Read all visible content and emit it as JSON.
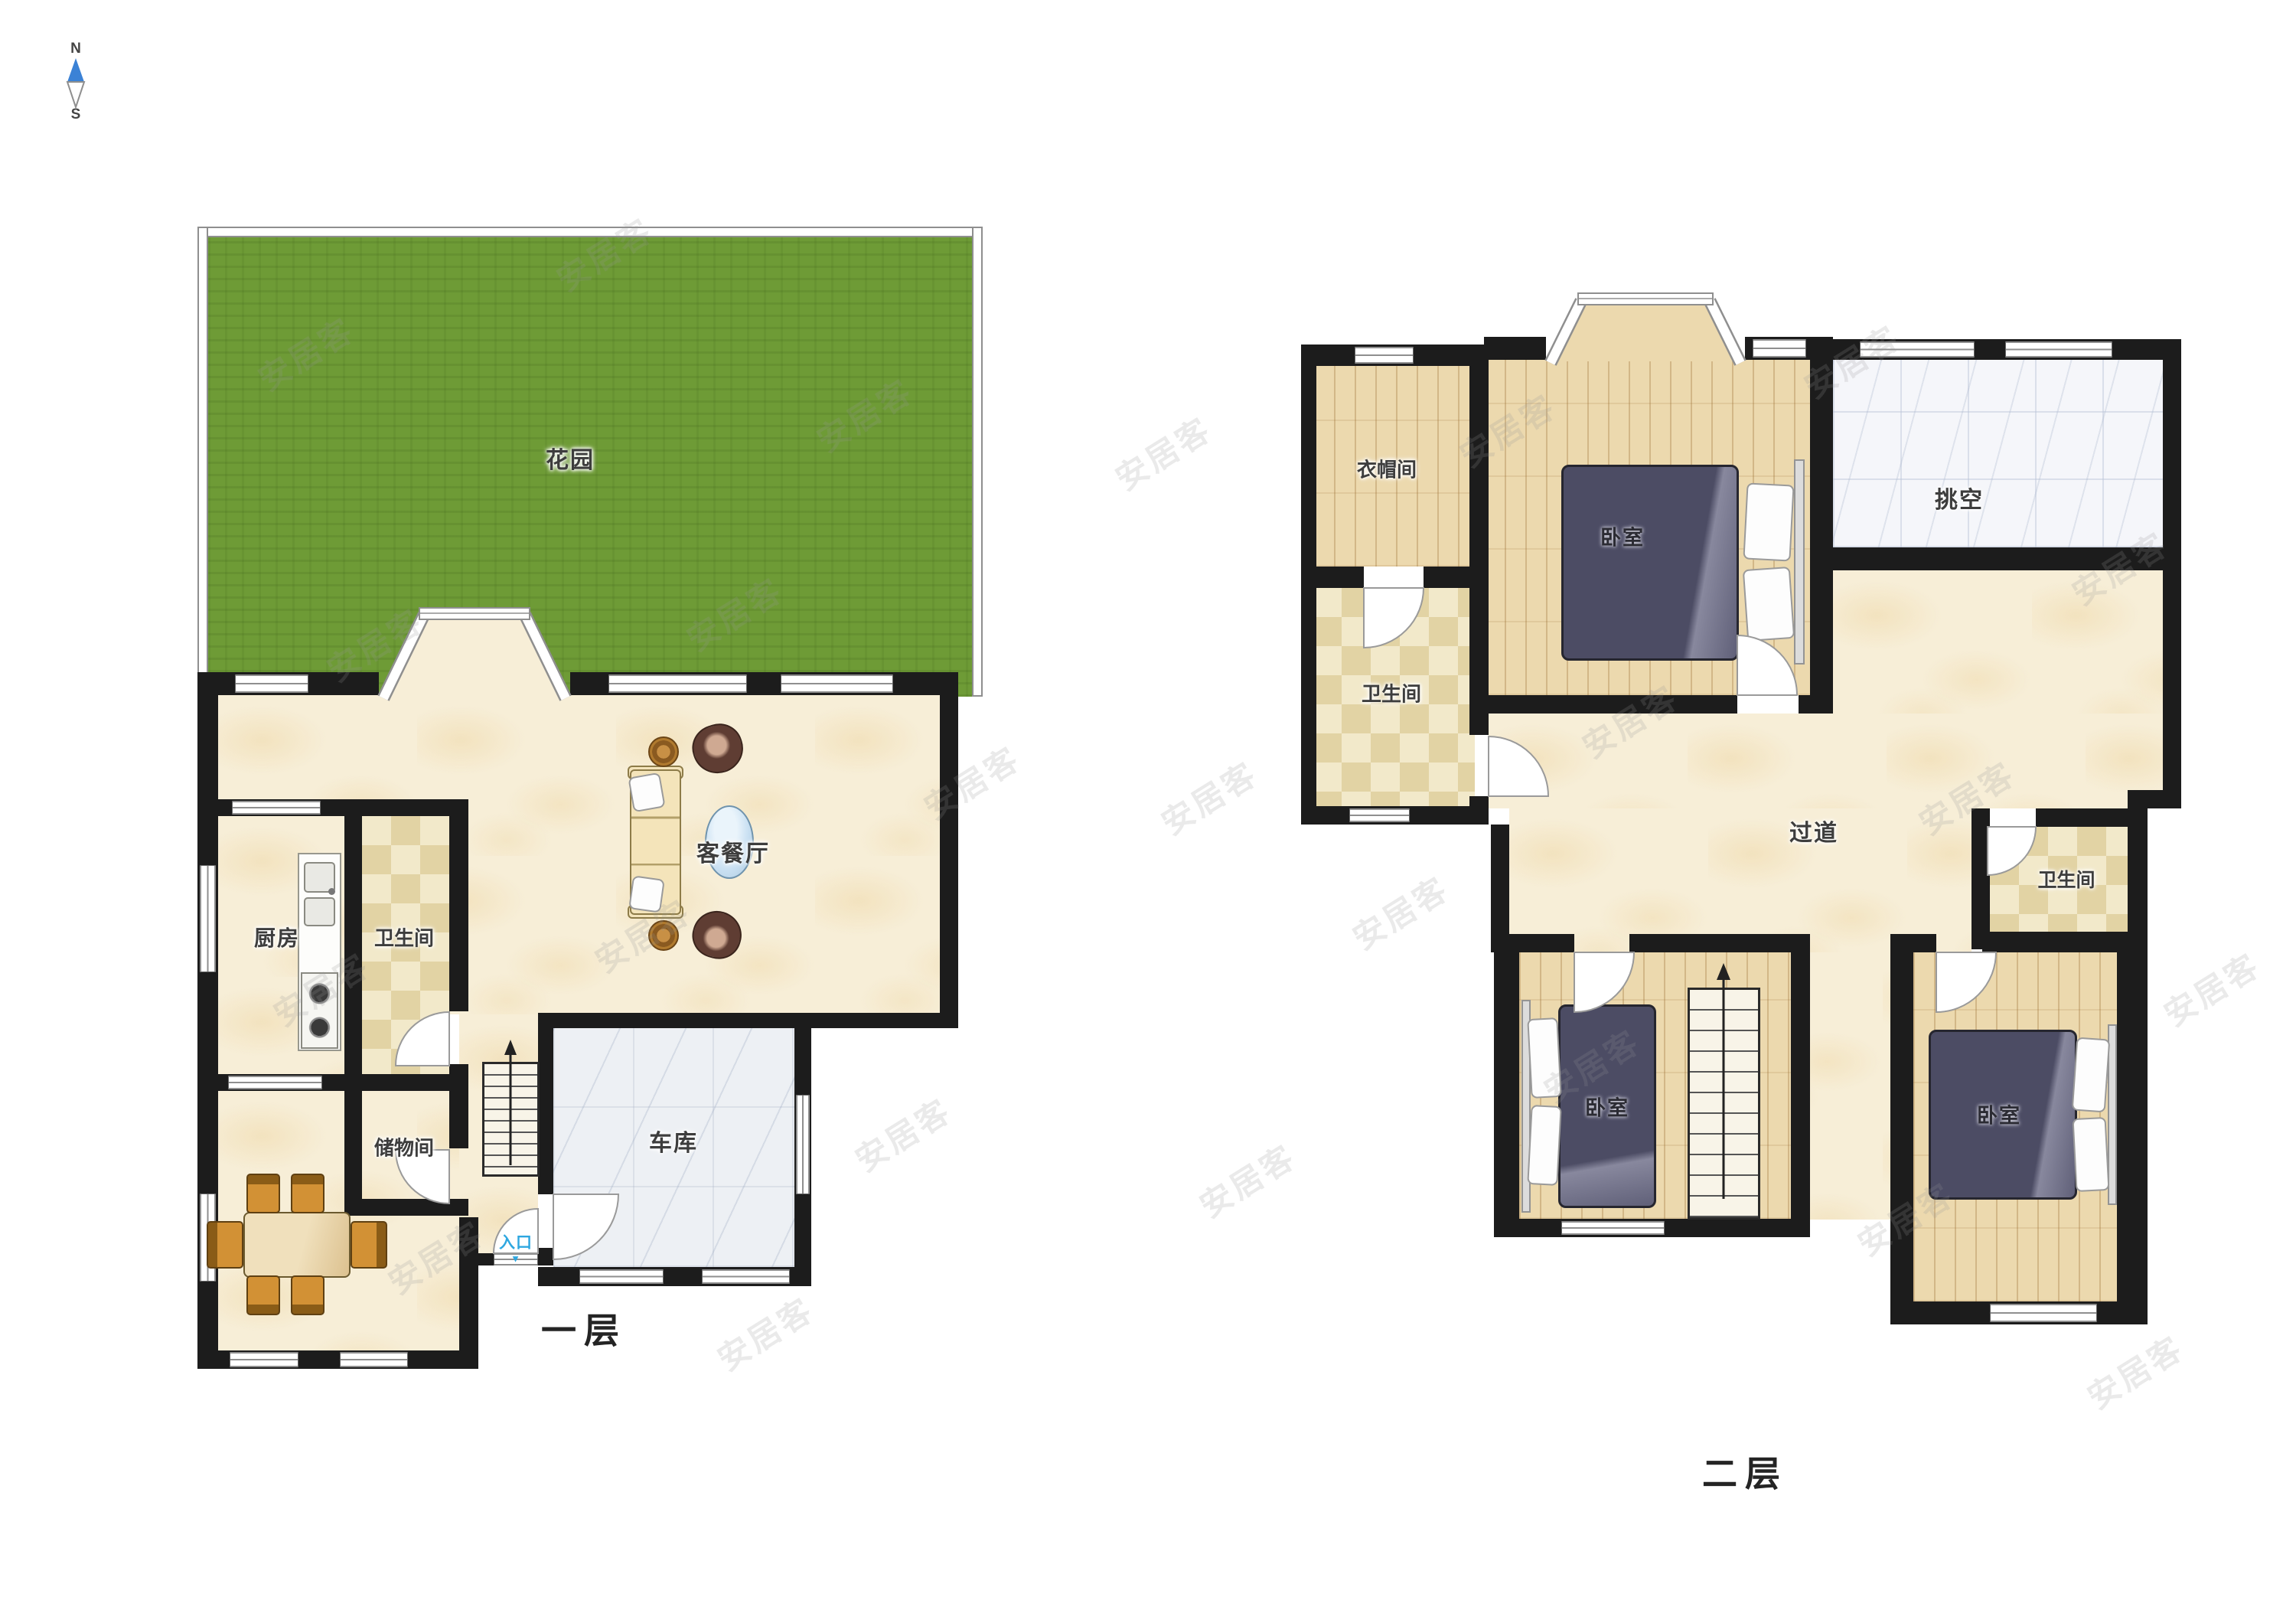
{
  "compass": {
    "north": "N",
    "south": "S"
  },
  "watermark": {
    "text": "安居客"
  },
  "floor1": {
    "label": "一层",
    "rooms": {
      "garden": "花园",
      "living_dining": "客餐厅",
      "kitchen": "厨房",
      "bathroom": "卫生间",
      "storage": "储物间",
      "garage": "车库"
    },
    "entrance": {
      "label": "入口",
      "arrow": "▼"
    }
  },
  "floor2": {
    "label": "二层",
    "rooms": {
      "cloakroom": "衣帽间",
      "bathroom_left": "卫生间",
      "bedroom_main": "卧室",
      "void": "挑空",
      "hallway": "过道",
      "bathroom_right": "卫生间",
      "bedroom_left": "卧室",
      "bedroom_right": "卧室"
    }
  },
  "colors": {
    "wall": "#1c1c1c",
    "garden": "#6e9b36",
    "floor_beige": "#f7eed7",
    "floor_wood": "#ecd9ae",
    "tile_check": "#e2d3a4",
    "garage_marble": "#edf0f4",
    "void_marble": "#f5f6fa",
    "bed": "#4c4c64",
    "sofa": "#f4e4ba",
    "coffee_table": "#c9e0f2",
    "dining_chair": "#d29135",
    "entrance_blue": "#2ea7e0",
    "compass_north": "#3b82d6"
  }
}
